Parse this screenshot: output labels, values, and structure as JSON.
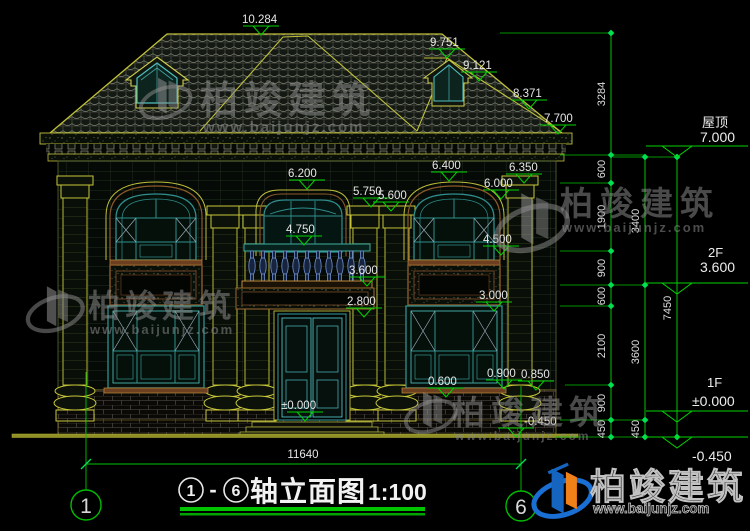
{
  "watermark": {
    "brand": "柏竣建筑",
    "url": "www.baijunjz.com"
  },
  "face_levels": {
    "l10284": "10.284",
    "l9751": "9.751",
    "l9121": "9.121",
    "l8371": "8.371",
    "l7700": "7.700",
    "l6200": "6.200",
    "l6400": "6.400",
    "l6350": "6.350",
    "l6000": "6.000",
    "l5750": "5.750",
    "l5600": "5.600",
    "l4750": "4.750",
    "l4500": "4.500",
    "l3600": "3.600",
    "l3000": "3.000",
    "l2800": "2.800",
    "l0000": "±0.000",
    "l0600": "0.600",
    "l0900": "0.900",
    "l0850": "0.850",
    "lm0450": "-0.450"
  },
  "right_panel": {
    "roof_label": "屋顶",
    "roof_value": "7.000",
    "f2_label": "2F",
    "f2_value": "3.600",
    "f1_label": "1F",
    "f1_value": "±0.000",
    "ground_value": "-0.450"
  },
  "chains": {
    "c1": [
      "3284",
      "600",
      "1900",
      "900",
      "600",
      "2100",
      "900",
      "450"
    ],
    "c2": [
      "3400",
      "3600",
      "450"
    ],
    "c3": [
      "7450"
    ]
  },
  "footer": {
    "total_width": "11640",
    "axis_left": "1",
    "axis_right": "6",
    "title_from": "1",
    "title_dash": "-",
    "title_to": "6",
    "title": "轴立面图",
    "scale": "1:100"
  }
}
